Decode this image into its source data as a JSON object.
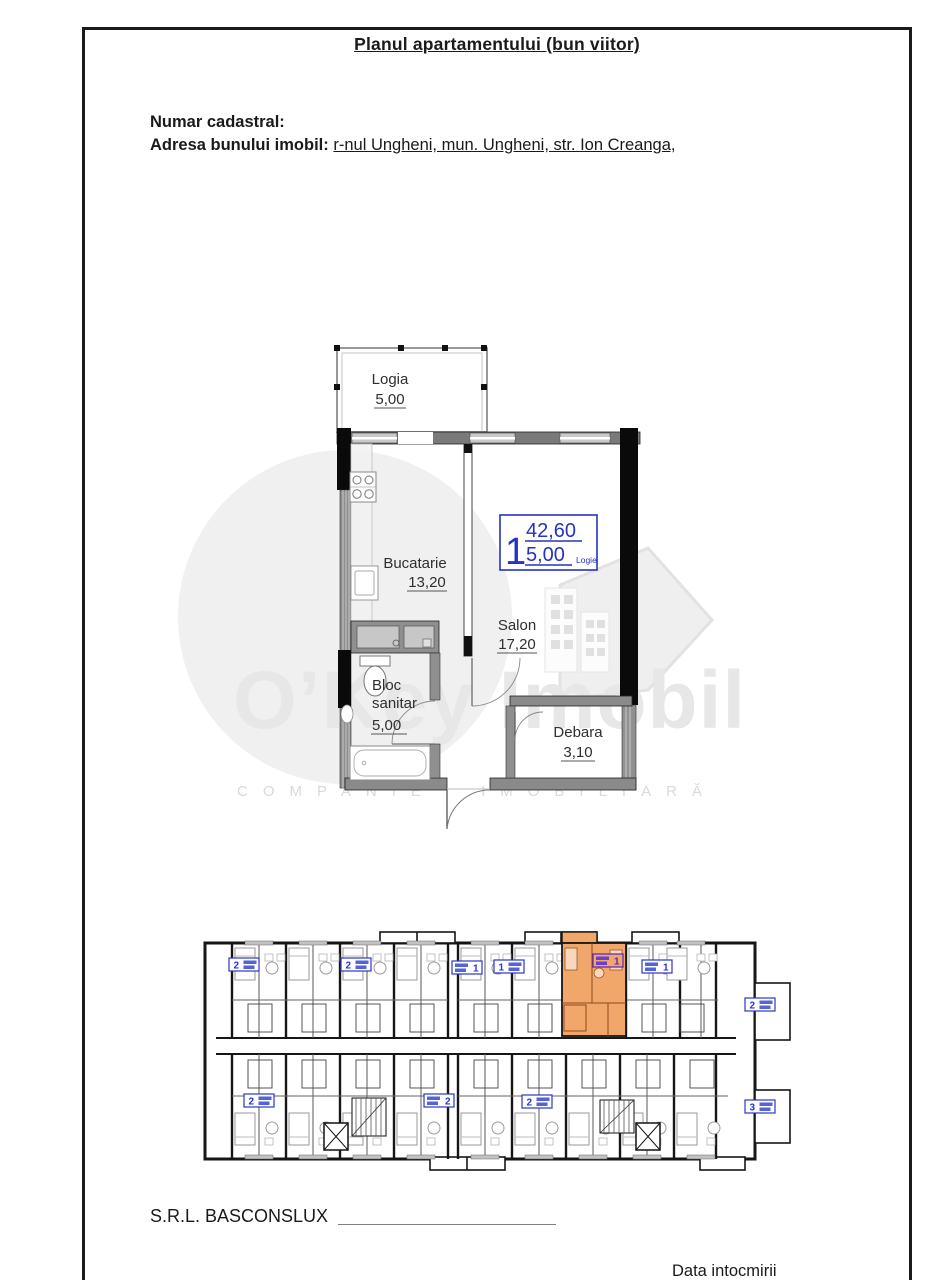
{
  "header": {
    "title": "Planul apartamentului (bun viitor)",
    "cadastral_label": "Numar cadastral:",
    "address_label": "Adresa bunului imobil:",
    "address_value": "r-nul Ungheni, mun. Ungheni, str. Ion Creanga,"
  },
  "apartment_plan": {
    "rooms": {
      "logia": {
        "name": "Logia",
        "area": "5,00"
      },
      "bucatarie": {
        "name": "Bucatarie",
        "area": "13,20"
      },
      "salon": {
        "name": "Salon",
        "area": "17,20"
      },
      "bloc_sanitar": {
        "line1": "Bloc",
        "line2": "sanitar",
        "area": "5,00"
      },
      "debara": {
        "name": "Debara",
        "area": "3,10"
      }
    },
    "unit_badge": {
      "number": "1",
      "total_area": "42,60",
      "logia_area": "5,00",
      "logia_label": "Logie"
    }
  },
  "watermark": {
    "brand": "O’Key Imobil",
    "tagline": "COMPANIE IMOBILIARĂ"
  },
  "building_plan": {
    "unit_labels": [
      "2",
      "2",
      "1",
      "1",
      "1",
      "1",
      "2",
      "2",
      "2",
      "2",
      "3"
    ],
    "highlighted_unit_index": 4,
    "highlighted_unit_number": "1"
  },
  "footer": {
    "company": "S.R.L. BASCONSLUX",
    "date_label": "Data intocmirii"
  },
  "colors": {
    "accent_blue": "#2936c8",
    "highlight_orange": "#f2a76a",
    "highlight_border_purple": "#5a22c8",
    "wall_black": "#111111",
    "wall_gray": "#8a8a8a",
    "watermark_gray": "#e7e7e7"
  }
}
